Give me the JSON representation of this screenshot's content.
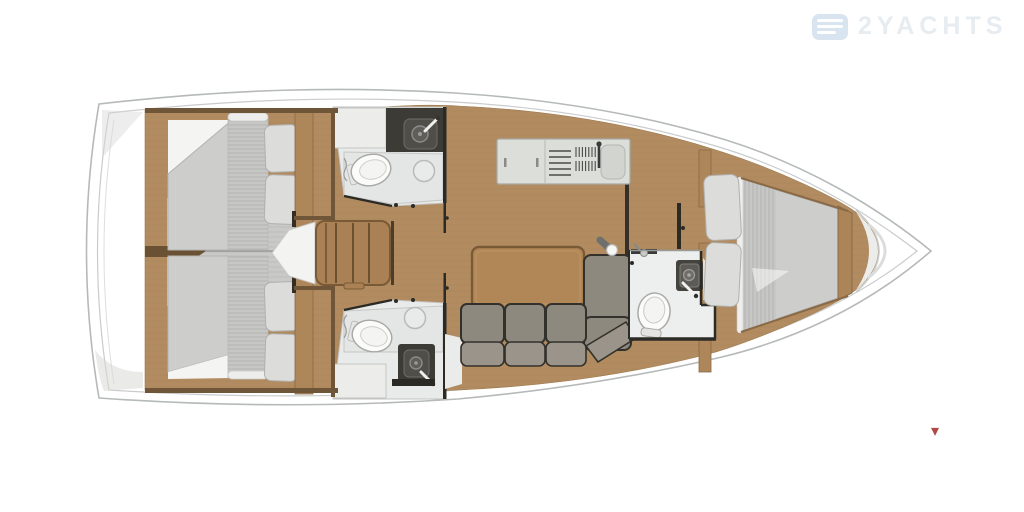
{
  "title": "2YACHTS",
  "watermark": {
    "brand": "2YACHTS",
    "logo_icon": "waves-logo"
  },
  "corner_marker": {
    "glyph": "▾"
  },
  "colors": {
    "page_bg": "#ffffff",
    "hull_outline": "#b6b9ba",
    "hull_inner_line": "#c9cbcc",
    "wood_floor": "#b28c60",
    "wood_wall": "#6f5638",
    "wood_trim": "#8a6a46",
    "wood_furniture": "#aa8155",
    "headboard_wood": "#ad8659",
    "table_wood": "#b18758",
    "table_edge": "#7a5a36",
    "mattress": "#cdcdcb",
    "mattress_stripe": "#b5b5b3",
    "pillow": "#dcdcda",
    "sofa": "#8e897e",
    "sofa_light": "#9a948a",
    "sofa_outline": "#33312b",
    "bath_floor": "#e9ebea",
    "shower_floor": "#e4e6e5",
    "fixture_white": "#fbfbfa",
    "counter_white": "#dcded9",
    "sink_dark": "#3d3b36",
    "wall_dark": "#2c2a25",
    "metal_gray": "#8b8b89",
    "watermark_logo": "#d8e4ef",
    "watermark_text": "#e7ecf1",
    "marker_red": "#b04848"
  },
  "plan": {
    "type": "sailing-yacht-interior-floor-plan-top-view",
    "bow_direction": "right",
    "areas": [
      {
        "id": "aft-cabin-top",
        "features": [
          "double-berth",
          "pillows",
          "headboard"
        ]
      },
      {
        "id": "aft-cabin-bottom",
        "features": [
          "double-berth",
          "pillows",
          "headboard"
        ]
      },
      {
        "id": "head-top",
        "features": [
          "toilet",
          "sink",
          "shower-drain",
          "vanity"
        ]
      },
      {
        "id": "head-bottom",
        "features": [
          "toilet",
          "sink",
          "shower-drain",
          "vanity"
        ]
      },
      {
        "id": "companionway",
        "features": [
          "steps",
          "engine-box"
        ]
      },
      {
        "id": "galley",
        "features": [
          "counter",
          "stove",
          "sink",
          "faucet"
        ]
      },
      {
        "id": "salon",
        "features": [
          "table",
          "l-shaped-sofa",
          "mast-post"
        ]
      },
      {
        "id": "forward-head",
        "features": [
          "toilet",
          "sink",
          "shower-mixer"
        ]
      },
      {
        "id": "forward-cabin",
        "features": [
          "v-berth",
          "pillows"
        ]
      },
      {
        "id": "bow",
        "features": [
          "anchor-locker"
        ]
      }
    ]
  }
}
